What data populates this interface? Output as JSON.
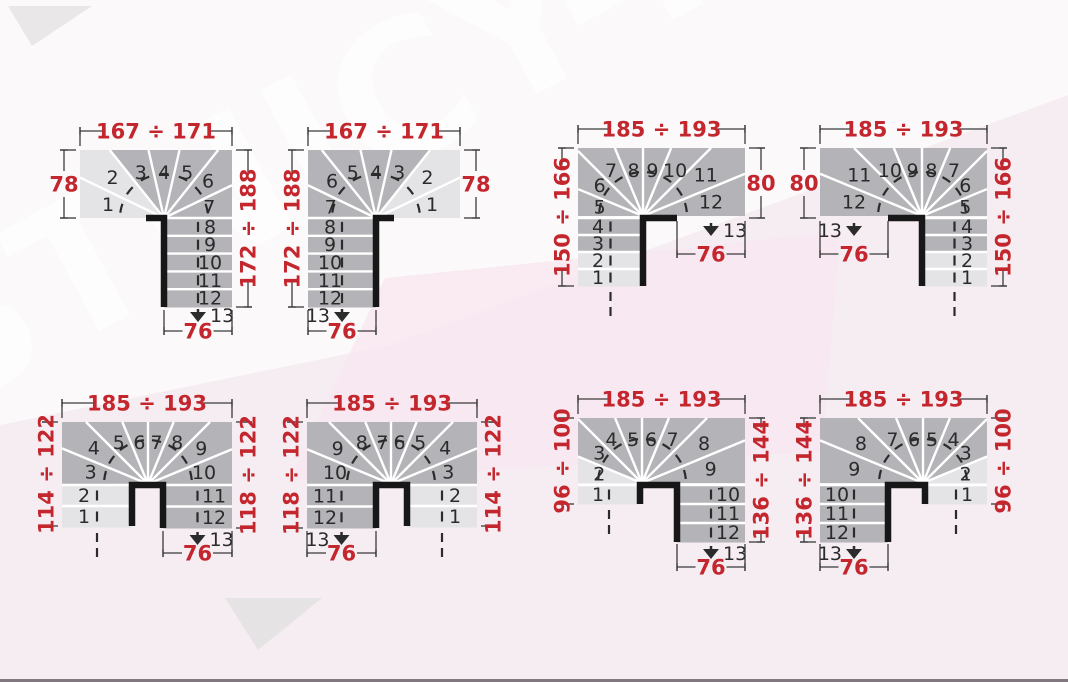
{
  "page": {
    "watermark": "LESTNICY-PROSTO.RU",
    "description": "Winder staircase layout plans with dimension ranges in centimetres",
    "total_steps_per_stair": "13"
  },
  "colors": {
    "dimension_red": "#c4262e",
    "dimension_line": "#3b3b3b",
    "step_light": "#e4e3e6",
    "step_dark": "#b4b3b7",
    "tread_white": "#ffffff",
    "wall_black": "#171717",
    "number_dark": "#2b2b2b",
    "background_pink": "#f6edf3",
    "background_white": "#fbf9fa"
  },
  "diagrams": [
    {
      "id": "d1",
      "type": "quarter",
      "mirrored": false,
      "dim_top": "167 ÷ 171",
      "dim_left": "78",
      "dim_right": "172 ÷ 188",
      "dim_bottom": "76",
      "entry_steps": [],
      "winder_steps": [
        1,
        2,
        3,
        4,
        5,
        6,
        7
      ],
      "exit_steps": [
        8,
        9,
        10,
        11,
        12
      ],
      "final_step": "13"
    },
    {
      "id": "d2",
      "type": "quarter",
      "mirrored": true,
      "dim_top": "167 ÷ 171",
      "dim_left": "172 ÷ 188",
      "dim_right": "78",
      "dim_bottom": "76",
      "entry_steps": [],
      "winder_steps": [
        1,
        2,
        3,
        4,
        5,
        6,
        7
      ],
      "exit_steps": [
        8,
        9,
        10,
        11,
        12
      ],
      "final_step": "13"
    },
    {
      "id": "d3",
      "type": "half_a",
      "mirrored": false,
      "dim_top": "185 ÷ 193",
      "dim_left": "150 ÷ 166",
      "dim_right": "80",
      "dim_bottom": "76",
      "entry_steps": [
        4,
        3,
        2,
        1
      ],
      "winder_steps": [
        5,
        6,
        7,
        8,
        9,
        10,
        11,
        12
      ],
      "exit_steps": [],
      "final_step": "13"
    },
    {
      "id": "d4",
      "type": "half_a",
      "mirrored": true,
      "dim_top": "185 ÷ 193",
      "dim_left": "80",
      "dim_right": "150 ÷ 166",
      "dim_bottom": "76",
      "entry_steps": [
        4,
        3,
        2,
        1
      ],
      "winder_steps": [
        5,
        6,
        7,
        8,
        9,
        10,
        11,
        12
      ],
      "exit_steps": [],
      "final_step": "13"
    },
    {
      "id": "d5",
      "type": "half_b",
      "mirrored": false,
      "dim_top": "185 ÷ 193",
      "dim_left": "114 ÷ 122",
      "dim_right": "118 ÷ 122",
      "dim_bottom": "76",
      "entry_steps": [
        2,
        1
      ],
      "winder_steps": [
        3,
        4,
        5,
        6,
        7,
        8,
        9,
        10
      ],
      "exit_steps": [
        11,
        12
      ],
      "final_step": "13"
    },
    {
      "id": "d6",
      "type": "half_b",
      "mirrored": true,
      "dim_top": "185 ÷ 193",
      "dim_left": "118 ÷ 122",
      "dim_right": "114 ÷ 122",
      "dim_bottom": "76",
      "entry_steps": [
        2,
        1
      ],
      "winder_steps": [
        3,
        4,
        5,
        6,
        7,
        8,
        9,
        10
      ],
      "exit_steps": [
        11,
        12
      ],
      "final_step": "13"
    },
    {
      "id": "d7",
      "type": "half_c",
      "mirrored": false,
      "dim_top": "185 ÷ 193",
      "dim_left": "96 ÷ 100",
      "dim_right": "136 ÷ 144",
      "dim_bottom": "76",
      "entry_steps": [
        1
      ],
      "winder_steps": [
        2,
        3,
        4,
        5,
        6,
        7,
        8,
        9
      ],
      "exit_steps": [
        10,
        11,
        12
      ],
      "final_step": "13"
    },
    {
      "id": "d8",
      "type": "half_c",
      "mirrored": true,
      "dim_top": "185 ÷ 193",
      "dim_left": "136 ÷ 144",
      "dim_right": "96 ÷ 100",
      "dim_bottom": "76",
      "entry_steps": [
        1
      ],
      "winder_steps": [
        2,
        3,
        4,
        5,
        6,
        7,
        8,
        9
      ],
      "exit_steps": [
        10,
        11,
        12
      ],
      "final_step": "13"
    }
  ]
}
